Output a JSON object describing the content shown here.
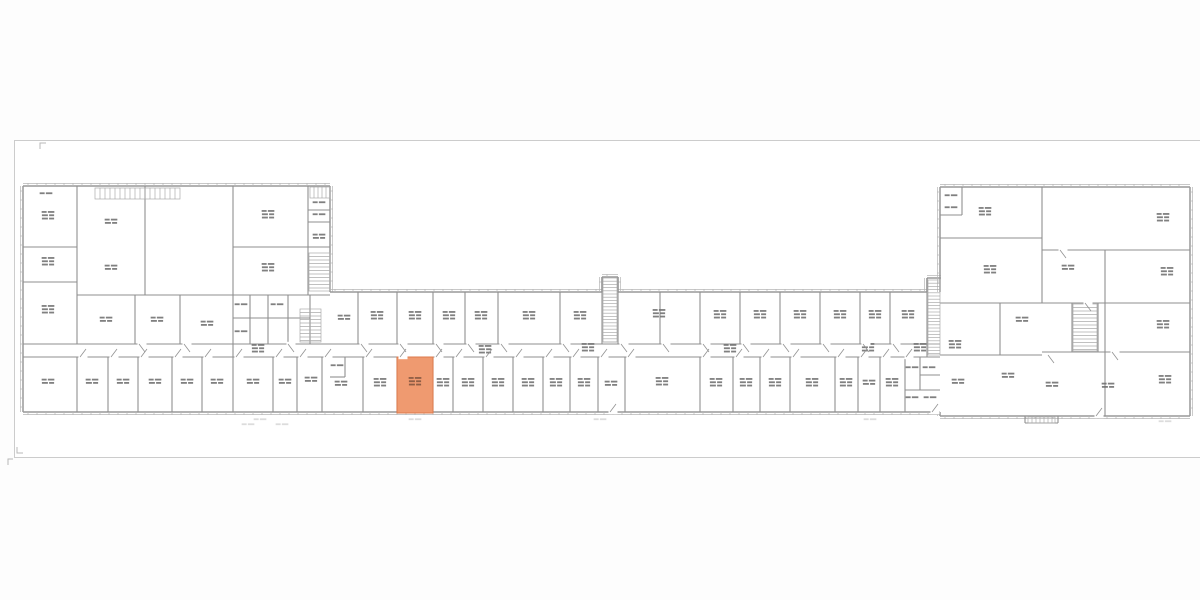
{
  "page": {
    "background": "#fdfdfd"
  },
  "canvas": {
    "x": 14.5,
    "y": 140.5,
    "w": 1190,
    "h": 317,
    "fill": "#ffffff",
    "border_color": "#cccccc"
  },
  "palette": {
    "exterior_wall": "#999999",
    "exterior_secondary": "#b5b5b5",
    "interior_wall": "#8f8f8f",
    "stair_hatch": "#ababab",
    "room_label": "#6f6f6f",
    "dim_mark": "#d4d4d4",
    "door_swing": "#909090",
    "corner_mark": "#b8b8b8",
    "highlight_fill": "#ef9a70",
    "highlight_stroke": "#dd7a4b",
    "highlight_label": "#8a5b43"
  },
  "plan": {
    "exterior_walls": [
      [
        23,
        186,
        330,
        186,
        0,
        -1
      ],
      [
        23,
        186,
        23,
        412,
        -1,
        0
      ],
      [
        23,
        412,
        940,
        412,
        0,
        1
      ],
      [
        330,
        186,
        330,
        292,
        1,
        0
      ],
      [
        330,
        292,
        602,
        292,
        0,
        -1
      ],
      [
        618,
        292,
        927,
        292,
        0,
        -1
      ],
      [
        602,
        277,
        618,
        277,
        0,
        -1
      ],
      [
        602,
        277,
        602,
        292,
        -1,
        0
      ],
      [
        618,
        277,
        618,
        292,
        1,
        0
      ],
      [
        927,
        278,
        941,
        278,
        0,
        -1
      ],
      [
        927,
        278,
        927,
        292,
        -1,
        0
      ],
      [
        940,
        187,
        940,
        292,
        -1,
        0
      ],
      [
        940,
        187,
        1190,
        187,
        0,
        -1
      ],
      [
        1190,
        187,
        1190,
        416,
        1,
        0
      ],
      [
        940,
        416,
        1190,
        416,
        0,
        1
      ],
      [
        940,
        412,
        940,
        416,
        -1,
        0
      ]
    ],
    "interior_walls": [
      [
        77,
        186,
        77,
        344
      ],
      [
        145,
        186,
        145,
        295
      ],
      [
        233,
        186,
        233,
        357
      ],
      [
        308,
        186,
        308,
        295
      ],
      [
        23,
        247,
        77,
        247
      ],
      [
        23,
        282,
        77,
        282
      ],
      [
        233,
        247,
        330,
        247
      ],
      [
        77,
        295,
        330,
        295
      ],
      [
        135,
        295,
        135,
        344
      ],
      [
        180,
        295,
        180,
        344
      ],
      [
        23,
        344,
        330,
        344
      ],
      [
        23,
        357,
        330,
        357
      ],
      [
        77,
        357,
        77,
        412
      ],
      [
        108,
        357,
        108,
        412
      ],
      [
        138,
        357,
        138,
        412
      ],
      [
        172,
        357,
        172,
        412
      ],
      [
        202,
        357,
        202,
        412
      ],
      [
        233,
        357,
        233,
        412
      ],
      [
        273,
        357,
        273,
        412
      ],
      [
        297,
        357,
        297,
        412
      ],
      [
        322,
        357,
        322,
        412
      ],
      [
        250,
        295,
        250,
        344
      ],
      [
        268,
        295,
        268,
        344
      ],
      [
        288,
        295,
        288,
        344
      ],
      [
        310,
        295,
        310,
        344
      ],
      [
        233,
        318,
        310,
        318
      ],
      [
        308,
        210,
        330,
        210
      ],
      [
        308,
        222,
        330,
        222
      ],
      [
        330,
        344,
        940,
        344
      ],
      [
        330,
        357,
        940,
        357
      ],
      [
        358,
        292,
        358,
        344
      ],
      [
        397,
        292,
        397,
        344
      ],
      [
        433,
        292,
        433,
        344
      ],
      [
        465,
        292,
        465,
        344
      ],
      [
        498,
        292,
        498,
        344
      ],
      [
        560,
        292,
        560,
        344
      ],
      [
        602,
        277,
        602,
        344
      ],
      [
        618,
        277,
        618,
        344
      ],
      [
        660,
        292,
        660,
        344
      ],
      [
        700,
        292,
        700,
        344
      ],
      [
        740,
        292,
        740,
        344
      ],
      [
        780,
        292,
        780,
        344
      ],
      [
        820,
        292,
        820,
        344
      ],
      [
        860,
        292,
        860,
        344
      ],
      [
        890,
        292,
        890,
        344
      ],
      [
        927,
        278,
        927,
        357
      ],
      [
        363,
        357,
        363,
        412
      ],
      [
        397,
        357,
        397,
        412
      ],
      [
        433,
        357,
        433,
        412
      ],
      [
        453,
        357,
        453,
        412
      ],
      [
        483,
        357,
        483,
        412
      ],
      [
        513,
        357,
        513,
        412
      ],
      [
        543,
        357,
        543,
        412
      ],
      [
        570,
        357,
        570,
        412
      ],
      [
        598,
        357,
        598,
        412
      ],
      [
        625,
        357,
        625,
        412
      ],
      [
        700,
        357,
        700,
        412
      ],
      [
        733,
        357,
        733,
        412
      ],
      [
        760,
        357,
        760,
        412
      ],
      [
        790,
        357,
        790,
        412
      ],
      [
        835,
        357,
        835,
        412
      ],
      [
        858,
        357,
        858,
        412
      ],
      [
        880,
        357,
        880,
        412
      ],
      [
        905,
        357,
        905,
        412
      ],
      [
        345,
        357,
        345,
        377
      ],
      [
        330,
        377,
        345,
        377
      ],
      [
        920,
        357,
        920,
        390
      ],
      [
        905,
        390,
        940,
        390
      ],
      [
        920,
        375,
        940,
        375
      ],
      [
        1042,
        187,
        1042,
        303
      ],
      [
        1105,
        250,
        1105,
        416
      ],
      [
        940,
        238,
        1042,
        238
      ],
      [
        1042,
        250,
        1190,
        250
      ],
      [
        940,
        303,
        1190,
        303
      ],
      [
        1042,
        352,
        1190,
        352
      ],
      [
        940,
        355,
        1042,
        355
      ],
      [
        962,
        187,
        962,
        215
      ],
      [
        940,
        215,
        962,
        215
      ],
      [
        1000,
        303,
        1000,
        355
      ],
      [
        1072,
        303,
        1072,
        352
      ],
      [
        1098,
        303,
        1098,
        352
      ],
      [
        1025,
        416,
        1025,
        423
      ],
      [
        1058,
        416,
        1058,
        423
      ],
      [
        1025,
        423,
        1058,
        423
      ]
    ],
    "stairs": [
      {
        "x": 95,
        "y": 188,
        "w": 85,
        "h": 11,
        "dir": "v",
        "s": 5
      },
      {
        "x": 310,
        "y": 187,
        "w": 20,
        "h": 11,
        "dir": "v",
        "s": 4
      },
      {
        "x": 309,
        "y": 253,
        "w": 21,
        "h": 38,
        "dir": "h",
        "s": 3.5
      },
      {
        "x": 300,
        "y": 309,
        "w": 21,
        "h": 33,
        "dir": "h",
        "s": 3.5
      },
      {
        "x": 603,
        "y": 278,
        "w": 14,
        "h": 64,
        "dir": "h",
        "s": 3.2
      },
      {
        "x": 928,
        "y": 280,
        "w": 12,
        "h": 75,
        "dir": "h",
        "s": 3.2
      },
      {
        "x": 1073,
        "y": 304,
        "w": 24,
        "h": 47,
        "dir": "h",
        "s": 3.5
      },
      {
        "x": 1028,
        "y": 417,
        "w": 27,
        "h": 6,
        "dir": "v",
        "s": 4
      }
    ],
    "room_labels": [
      [
        48,
        216,
        3
      ],
      [
        48,
        262,
        3
      ],
      [
        48,
        310,
        3
      ],
      [
        48,
        382,
        2
      ],
      [
        111,
        222,
        2
      ],
      [
        111,
        268,
        2
      ],
      [
        46,
        194,
        1
      ],
      [
        268,
        215,
        3
      ],
      [
        268,
        268,
        3
      ],
      [
        319,
        203,
        1
      ],
      [
        319,
        215,
        1
      ],
      [
        319,
        237,
        2
      ],
      [
        106,
        320,
        2
      ],
      [
        157,
        320,
        2
      ],
      [
        207,
        324,
        2
      ],
      [
        241,
        305,
        1
      ],
      [
        241,
        332,
        1
      ],
      [
        277,
        305,
        1
      ],
      [
        92,
        382,
        2
      ],
      [
        123,
        382,
        2
      ],
      [
        155,
        382,
        2
      ],
      [
        187,
        382,
        2
      ],
      [
        217,
        382,
        2
      ],
      [
        253,
        382,
        2
      ],
      [
        285,
        382,
        2
      ],
      [
        311,
        380,
        2
      ],
      [
        344,
        318,
        2
      ],
      [
        377,
        316,
        3
      ],
      [
        415,
        316,
        3
      ],
      [
        449,
        316,
        3
      ],
      [
        481,
        316,
        3
      ],
      [
        529,
        316,
        3
      ],
      [
        580,
        316,
        3
      ],
      [
        659,
        314,
        3
      ],
      [
        720,
        315,
        3
      ],
      [
        760,
        315,
        3
      ],
      [
        800,
        315,
        3
      ],
      [
        840,
        315,
        3
      ],
      [
        875,
        315,
        3
      ],
      [
        908,
        315,
        3
      ],
      [
        341,
        384,
        2
      ],
      [
        337,
        366,
        1
      ],
      [
        380,
        383,
        3
      ],
      [
        443,
        383,
        3
      ],
      [
        468,
        383,
        3
      ],
      [
        498,
        383,
        3
      ],
      [
        528,
        383,
        3
      ],
      [
        556,
        383,
        3
      ],
      [
        584,
        383,
        3
      ],
      [
        611,
        384,
        2
      ],
      [
        662,
        382,
        3
      ],
      [
        716,
        383,
        3
      ],
      [
        746,
        383,
        3
      ],
      [
        775,
        383,
        3
      ],
      [
        812,
        383,
        3
      ],
      [
        846,
        383,
        3
      ],
      [
        869,
        383,
        2
      ],
      [
        892,
        383,
        3
      ],
      [
        912,
        368,
        1
      ],
      [
        929,
        368,
        1
      ],
      [
        912,
        398,
        1
      ],
      [
        930,
        398,
        1
      ],
      [
        258,
        349,
        3
      ],
      [
        485,
        350,
        3
      ],
      [
        588,
        348,
        3
      ],
      [
        730,
        349,
        3
      ],
      [
        868,
        348,
        3
      ],
      [
        920,
        348,
        3
      ],
      [
        951,
        196,
        1
      ],
      [
        951,
        208,
        1
      ],
      [
        985,
        212,
        3
      ],
      [
        990,
        270,
        3
      ],
      [
        1163,
        218,
        3
      ],
      [
        1068,
        268,
        2
      ],
      [
        1167,
        272,
        3
      ],
      [
        1163,
        325,
        3
      ],
      [
        1165,
        380,
        3
      ],
      [
        958,
        382,
        2
      ],
      [
        1008,
        376,
        2
      ],
      [
        1052,
        385,
        2
      ],
      [
        1108,
        386,
        2
      ],
      [
        955,
        345,
        3
      ],
      [
        1022,
        320,
        2
      ],
      [
        260,
        420,
        1,
        "dim"
      ],
      [
        415,
        420,
        1,
        "dim"
      ],
      [
        600,
        420,
        1,
        "dim"
      ],
      [
        870,
        420,
        1,
        "dim"
      ],
      [
        1165,
        422,
        1,
        "dim"
      ],
      [
        248,
        425,
        1,
        "dim"
      ],
      [
        282,
        425,
        1,
        "dim"
      ]
    ],
    "doors": [
      [
        80,
        357,
        -8
      ],
      [
        111,
        357,
        -8
      ],
      [
        141,
        357,
        -8
      ],
      [
        175,
        357,
        -8
      ],
      [
        205,
        357,
        -8
      ],
      [
        236,
        357,
        -8
      ],
      [
        276,
        357,
        -8
      ],
      [
        300,
        357,
        -8
      ],
      [
        325,
        357,
        -8
      ],
      [
        366,
        357,
        -8
      ],
      [
        400,
        357,
        -8
      ],
      [
        436,
        357,
        -8
      ],
      [
        456,
        357,
        -8
      ],
      [
        486,
        357,
        -8
      ],
      [
        516,
        357,
        -8
      ],
      [
        546,
        357,
        -8
      ],
      [
        573,
        357,
        -8
      ],
      [
        601,
        357,
        -8
      ],
      [
        628,
        357,
        -8
      ],
      [
        703,
        357,
        -8
      ],
      [
        736,
        357,
        -8
      ],
      [
        763,
        357,
        -8
      ],
      [
        793,
        357,
        -8
      ],
      [
        838,
        357,
        -8
      ],
      [
        861,
        357,
        -8
      ],
      [
        883,
        357,
        -8
      ],
      [
        906,
        357,
        -8
      ],
      [
        139,
        344,
        8
      ],
      [
        184,
        344,
        8
      ],
      [
        288,
        344,
        8
      ],
      [
        361,
        344,
        8
      ],
      [
        400,
        344,
        8
      ],
      [
        436,
        344,
        8
      ],
      [
        468,
        344,
        8
      ],
      [
        501,
        344,
        8
      ],
      [
        563,
        344,
        8
      ],
      [
        621,
        344,
        8
      ],
      [
        663,
        344,
        8
      ],
      [
        703,
        344,
        8
      ],
      [
        743,
        344,
        8
      ],
      [
        783,
        344,
        8
      ],
      [
        823,
        344,
        8
      ],
      [
        863,
        344,
        8
      ],
      [
        893,
        344,
        8
      ],
      [
        1096,
        416,
        -8
      ],
      [
        1048,
        355,
        8
      ],
      [
        1085,
        303,
        8
      ],
      [
        1112,
        352,
        8
      ],
      [
        1060,
        250,
        8
      ],
      [
        610,
        412,
        -8
      ],
      [
        932,
        412,
        -8
      ]
    ],
    "corner_marks": [
      [
        [
          40,
          149
        ],
        [
          40,
          143
        ],
        [
          46,
          143
        ]
      ],
      [
        [
          17,
          447
        ],
        [
          17,
          453
        ],
        [
          23,
          453
        ]
      ],
      [
        [
          13,
          459
        ],
        [
          8,
          459
        ],
        [
          8,
          465
        ]
      ]
    ],
    "highlight": {
      "x": 397,
      "y": 357,
      "w": 36,
      "h": 56,
      "label": {
        "x": 415,
        "y": 382,
        "lines": 3
      }
    }
  }
}
